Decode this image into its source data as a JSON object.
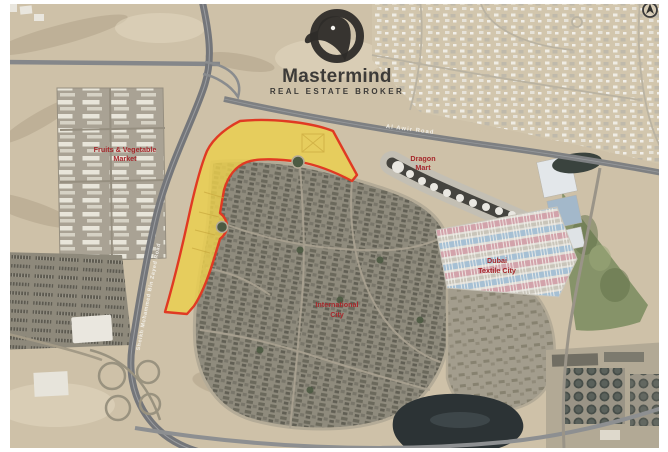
{
  "brand": {
    "name": "Mastermind",
    "tagline": "REAL ESTATE BROKER"
  },
  "map": {
    "labels": {
      "market": {
        "line1": "Fruits & Vegetable",
        "line2": "Market"
      },
      "dragon_mart": {
        "line1": "Dragon",
        "line2": "Mart"
      },
      "textile_city": {
        "line1": "Dubai",
        "line2": "Textile City"
      },
      "international_city": {
        "line1": "International",
        "line2": "City"
      },
      "roads": {
        "al_awir": "Al Awir Road",
        "mbz": "Sheikh Mohammed Bin Zayed Road"
      }
    },
    "highlight": {
      "description": "highlighted land plot"
    }
  },
  "colors": {
    "parcel_fill": "#EBCF4D",
    "parcel_stroke": "#E03A23",
    "label_red": "#A6282C",
    "road_label": "#F5F3ED",
    "logo_dark": "#2E2C29",
    "logo_text": "#3D3B38",
    "sand": "#CEC1A8"
  }
}
